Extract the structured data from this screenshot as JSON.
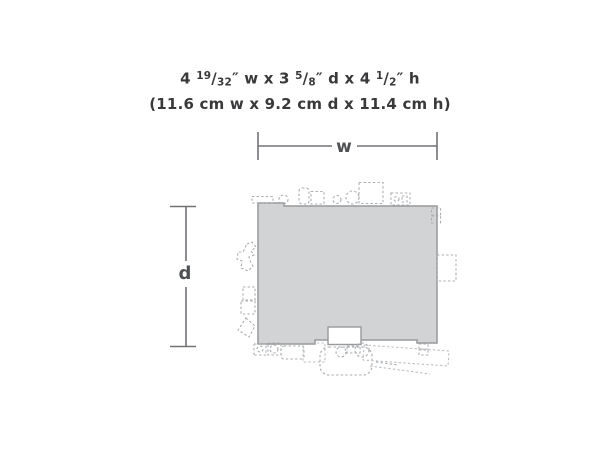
{
  "header": {
    "imperial_segments": [
      "4 ",
      "19",
      "/",
      "32",
      "″ w x 3 ",
      "5",
      "/",
      "8",
      "″ d x 4 ",
      "1",
      "/",
      "2",
      "″ h"
    ],
    "imperial_full": "4 19/32″ w x 3 5/8″ d x 4 1/2″ h",
    "metric_text": "(11.6 cm w x 9.2 cm d x 11.4 cm h)"
  },
  "diagram": {
    "width_label": "w",
    "depth_label": "d"
  },
  "colors": {
    "background": "#ffffff",
    "footprint_fill": "#d2d3d5",
    "footprint_outline": "#97999c",
    "dashed_details": "#a9acaf",
    "dimension_lines": "#707276",
    "text": "#39393b"
  }
}
